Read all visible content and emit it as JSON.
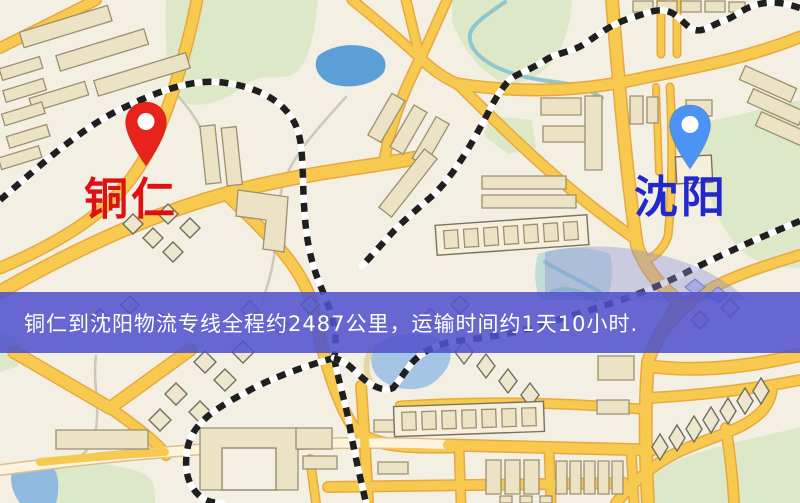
{
  "window": {
    "width": 800,
    "height": 503
  },
  "map": {
    "description": "stylized logistics route map",
    "origin": {
      "name": "铜仁",
      "pin_color": "#e8231c",
      "label_color": "#dd1111"
    },
    "destination": {
      "name": "沈阳",
      "pin_color": "#4b93f5",
      "label_color": "#2128cc"
    },
    "banner": {
      "text": "铜仁到沈阳物流专线全程约2487公里，运输时间约1天10小时.",
      "background_color": "#5053cd",
      "text_color": "#ffffff",
      "distance_km": "2487",
      "duration_text": "1天10小时"
    },
    "palette": {
      "background": "#f4efe3",
      "road": "#f7c94f",
      "road_casing": "#e7a93f",
      "park": "#dde8c8",
      "water": "#5c9ed8",
      "railway": "#1f1f1f",
      "building": "#ece2c4"
    }
  }
}
